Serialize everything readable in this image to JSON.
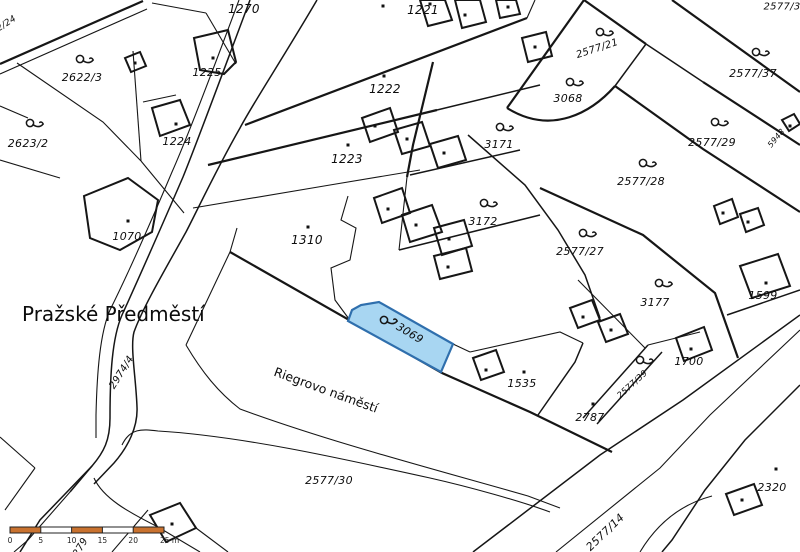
{
  "map": {
    "type": "cadastral-map",
    "district_label": "Pražské Předměstí",
    "square_label": "Riegrovo náměstí",
    "highlighted_parcel": {
      "id": "3069",
      "fill": "#a8d6f2",
      "stroke": "#2f6fad"
    },
    "colors": {
      "line": "#161616",
      "background": "#ffffff",
      "scalebar_orange": "#c9722f"
    },
    "place_labels": [
      {
        "text": "Pražské Předměstí",
        "x": 22,
        "y": 314,
        "rot": 0,
        "size": 20,
        "anchor": "start",
        "cls": "place"
      },
      {
        "text": "Riegrovo náměstí",
        "x": 326,
        "y": 390,
        "rot": 20,
        "size": 12.5,
        "anchor": "middle",
        "cls": "place"
      }
    ],
    "parcel_labels": [
      {
        "text": "2/24",
        "x": 6,
        "y": 23,
        "rot": -33,
        "size": 9
      },
      {
        "text": "2622/3",
        "x": 82,
        "y": 77,
        "rot": 0,
        "size": 11
      },
      {
        "text": "2623/2",
        "x": 28,
        "y": 143,
        "rot": 0,
        "size": 11
      },
      {
        "text": "1070",
        "x": 127,
        "y": 236,
        "rot": 0,
        "size": 11
      },
      {
        "text": "1225",
        "x": 207,
        "y": 72,
        "rot": 0,
        "size": 11
      },
      {
        "text": "1224",
        "x": 177,
        "y": 141,
        "rot": 0,
        "size": 11
      },
      {
        "text": "1270",
        "x": 244,
        "y": 9,
        "rot": 0,
        "size": 12
      },
      {
        "text": "1221",
        "x": 423,
        "y": 10,
        "rot": 0,
        "size": 12
      },
      {
        "text": "1222",
        "x": 385,
        "y": 89,
        "rot": 0,
        "size": 12
      },
      {
        "text": "1223",
        "x": 347,
        "y": 159,
        "rot": 0,
        "size": 12
      },
      {
        "text": "3171",
        "x": 499,
        "y": 144,
        "rot": 0,
        "size": 11
      },
      {
        "text": "3172",
        "x": 483,
        "y": 221,
        "rot": 0,
        "size": 11
      },
      {
        "text": "1310",
        "x": 307,
        "y": 240,
        "rot": 0,
        "size": 12
      },
      {
        "text": "3068",
        "x": 568,
        "y": 98,
        "rot": 0,
        "size": 11
      },
      {
        "text": "2577/21",
        "x": 597,
        "y": 48,
        "rot": -18,
        "size": 10
      },
      {
        "text": "2577/37",
        "x": 753,
        "y": 73,
        "rot": 0,
        "size": 11
      },
      {
        "text": "2577/3",
        "x": 782,
        "y": 6,
        "rot": 0,
        "size": 10
      },
      {
        "text": "5948",
        "x": 776,
        "y": 138,
        "rot": -50,
        "size": 8
      },
      {
        "text": "2577/29",
        "x": 712,
        "y": 142,
        "rot": 0,
        "size": 11
      },
      {
        "text": "2577/28",
        "x": 641,
        "y": 181,
        "rot": 0,
        "size": 11
      },
      {
        "text": "2577/27",
        "x": 580,
        "y": 251,
        "rot": 0,
        "size": 11
      },
      {
        "text": "3177",
        "x": 655,
        "y": 302,
        "rot": 0,
        "size": 11
      },
      {
        "text": "1599",
        "x": 763,
        "y": 295,
        "rot": 0,
        "size": 11
      },
      {
        "text": "1700",
        "x": 689,
        "y": 361,
        "rot": 0,
        "size": 11
      },
      {
        "text": "2577/39",
        "x": 632,
        "y": 384,
        "rot": -42,
        "size": 8.5
      },
      {
        "text": "1535",
        "x": 522,
        "y": 383,
        "rot": 0,
        "size": 11
      },
      {
        "text": "2787",
        "x": 590,
        "y": 417,
        "rot": 0,
        "size": 11
      },
      {
        "text": "2320",
        "x": 772,
        "y": 487,
        "rot": 0,
        "size": 11
      },
      {
        "text": "2577/30",
        "x": 329,
        "y": 480,
        "rot": 0,
        "size": 11
      },
      {
        "text": "2577/14",
        "x": 605,
        "y": 532,
        "rot": -44,
        "size": 11
      },
      {
        "text": "2974/4",
        "x": 121,
        "y": 372,
        "rot": -58,
        "size": 10
      },
      {
        "text": "3069",
        "x": 410,
        "y": 333,
        "rot": 31,
        "size": 11
      },
      {
        "text": "279",
        "x": 80,
        "y": 547,
        "rot": -60,
        "size": 10
      }
    ],
    "garden_symbols": [
      [
        80,
        59
      ],
      [
        30,
        123
      ],
      [
        600,
        32
      ],
      [
        570,
        82
      ],
      [
        500,
        127
      ],
      [
        484,
        203
      ],
      [
        756,
        52
      ],
      [
        715,
        122
      ],
      [
        643,
        163
      ],
      [
        583,
        233
      ],
      [
        659,
        283
      ],
      [
        640,
        360
      ],
      [
        384,
        320
      ]
    ],
    "building_dots": [
      [
        135,
        63
      ],
      [
        213,
        58
      ],
      [
        176,
        124
      ],
      [
        128,
        221
      ],
      [
        383,
        6
      ],
      [
        430,
        4
      ],
      [
        465,
        15
      ],
      [
        508,
        7
      ],
      [
        535,
        47
      ],
      [
        384,
        76
      ],
      [
        348,
        145
      ],
      [
        308,
        227
      ],
      [
        375,
        126
      ],
      [
        407,
        139
      ],
      [
        444,
        153
      ],
      [
        388,
        209
      ],
      [
        416,
        225
      ],
      [
        449,
        239
      ],
      [
        448,
        267
      ],
      [
        486,
        370
      ],
      [
        524,
        372
      ],
      [
        593,
        404
      ],
      [
        691,
        349
      ],
      [
        766,
        283
      ],
      [
        723,
        213
      ],
      [
        748,
        222
      ],
      [
        776,
        469
      ],
      [
        583,
        317
      ],
      [
        611,
        330
      ],
      [
        790,
        126
      ],
      [
        172,
        524
      ],
      [
        742,
        500
      ]
    ],
    "scale_bar": {
      "x": 10,
      "y": 527,
      "height": 6,
      "segment_px": 30.8,
      "segments": 5,
      "tick_labels": [
        "0",
        "5",
        "10",
        "15",
        "20",
        "25 m"
      ],
      "orange": "#c9722f"
    }
  }
}
